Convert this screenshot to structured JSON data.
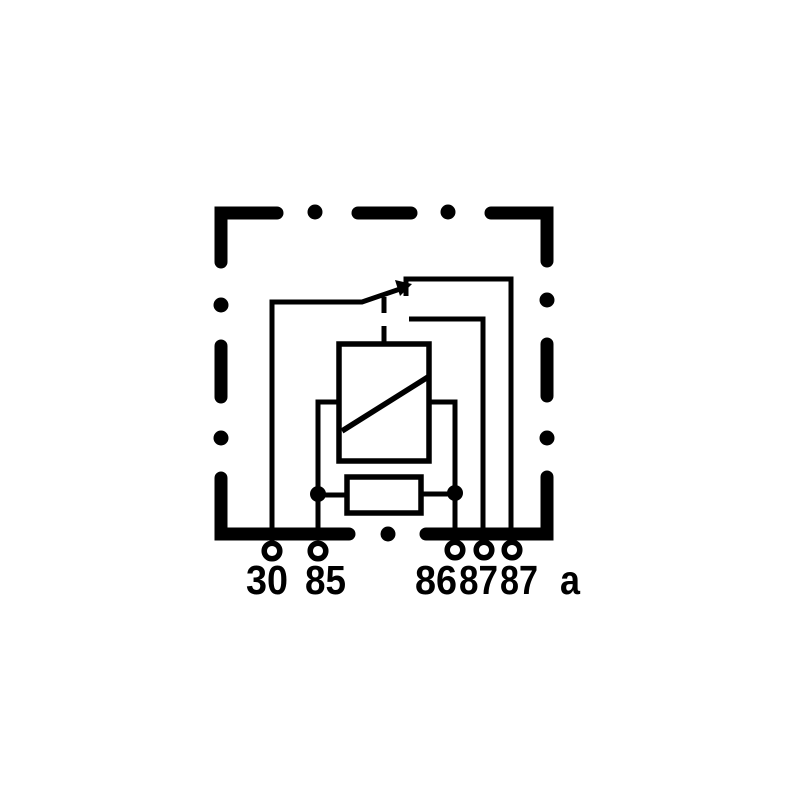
{
  "colors": {
    "ink": "#000000",
    "background": "#ffffff"
  },
  "diagram": {
    "kind": "relay-wiring-schematic"
  },
  "terminals": [
    {
      "id": "30",
      "label": "30"
    },
    {
      "id": "85",
      "label": "85"
    },
    {
      "id": "86",
      "label": "86"
    },
    {
      "id": "87",
      "label": "87"
    },
    {
      "id": "87a",
      "label": "87",
      "suffix": "a"
    }
  ]
}
